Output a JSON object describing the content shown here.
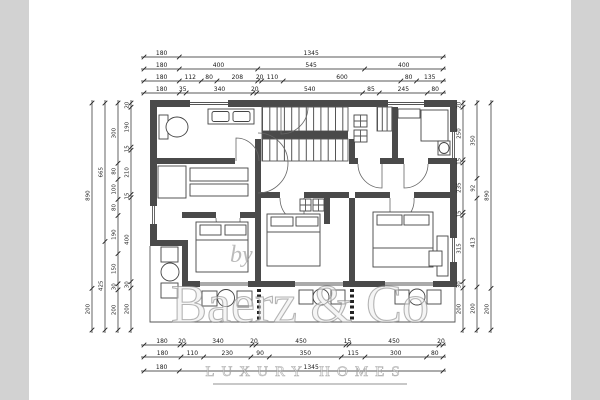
{
  "colors": {
    "wall": "#4a4a4a",
    "dimension_line": "#222222",
    "sidebar_gray": "#d2d2d2",
    "watermark_gray": "#8f8f8f"
  },
  "watermark": {
    "by": "by",
    "brand": "Baerz & Co",
    "tagline": "LUXURY HOMES"
  },
  "dims": {
    "t1": [
      "180",
      "1345"
    ],
    "t2": [
      "180",
      "400",
      "545",
      "400"
    ],
    "t3": [
      "180",
      "112",
      "80",
      "208",
      "20",
      "110",
      "600",
      "80",
      "135"
    ],
    "t4": [
      "180",
      "35",
      "340",
      "20",
      "540",
      "85",
      "245",
      "80"
    ],
    "b1": [
      "180",
      "20",
      "340",
      "20",
      "450",
      "15",
      "450",
      "20"
    ],
    "b2": [
      "180",
      "110",
      "230",
      "90",
      "350",
      "115",
      "300",
      "80"
    ],
    "b3": [
      "180",
      "1345"
    ],
    "l1": [
      "890",
      "200"
    ],
    "l2": [
      "665",
      "425"
    ],
    "l3": [
      "300",
      "80",
      "100",
      "80",
      "190",
      "150",
      "30",
      "200"
    ],
    "l4": [
      "20",
      "190",
      "15",
      "210",
      "15",
      "400",
      "30",
      "200"
    ],
    "r1": [
      "20",
      "250",
      "15",
      "235",
      "15",
      "315",
      "30",
      "200"
    ],
    "r2": [
      "350",
      "92",
      "413",
      "200"
    ],
    "r3": [
      "890",
      "200"
    ]
  }
}
